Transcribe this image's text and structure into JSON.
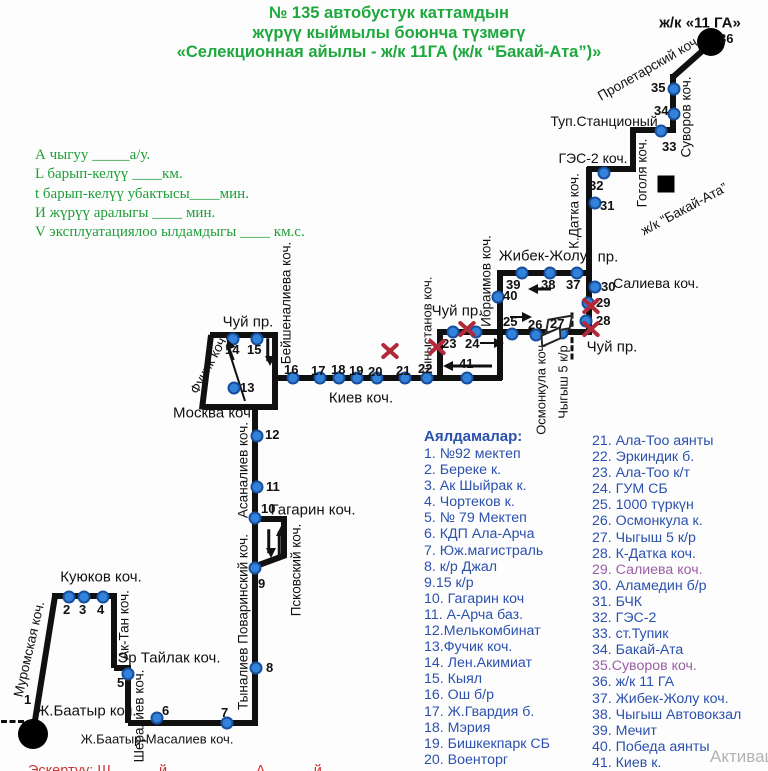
{
  "title": {
    "line1": "№ 135  автобустук каттамдын",
    "line2": "жүрүү кыймылы боюнча түзмөгү",
    "line3": "«Селекционная айылы - ж/к 11ГА (ж/к “Бакай-Ата”)»"
  },
  "legend": {
    "lines": [
      "А чыгуу  _____а/у.",
      "L барып-келүү  ____км.",
      "t барып-келүү убактысы____мин.",
      "И жүрүү аралыгы ____  мин.",
      "V эксплуатациялоо ылдамдыгы ____ км.с."
    ]
  },
  "stops_list": {
    "heading": "Аялдамалар:",
    "column1": [
      "1. №92 мектеп",
      "2. Береке к.",
      "3. Ак Шыйрак к.",
      "4. Чортеков к.",
      "5.  № 79 Мектеп",
      "6. КДП Ала-Арча",
      "7. Юж.магистраль",
      "8. к/р Джал",
      "9.15 к/р",
      "10. Гагарин коч",
      "11. А-Арча баз.",
      "12.Мелькомбинат",
      "13.Фучик коч.",
      "14. Лен.Акимиат",
      "15. Кыял",
      "16. Ош б/р",
      "17. Ж.Гвардия б.",
      "18. Мэрия",
      "19. Бишкекпарк СБ",
      "20. Военторг"
    ],
    "column2": [
      "21. Ала-Тоо аянты",
      "22. Эркиндик б.",
      "23. Ала-Тоо к/т",
      "24. ГУМ СБ",
      "25. 1000 түркүн",
      "26. Осмонкула к.",
      "27. Чыгыш 5 к/р",
      "28. К-Датка коч.",
      "29. Салиева коч.",
      "30. Аламедин б/р",
      "31. БЧК",
      "32. ГЭС-2",
      "33. ст.Тупик",
      "34. Бакай-Ата",
      "35.Суворов коч.",
      "36. ж/к 11 ГА",
      "37. Жибек-Жолу коч.",
      "38. Чыгыш Автовокзал",
      "39. Мечит",
      "40. Победа аянты",
      "41. Киев к."
    ],
    "purple_items": [
      "29. Салиева коч.",
      "35.Суворов коч."
    ]
  },
  "map": {
    "segments": [
      [
        33,
        733,
        55,
        596
      ],
      [
        52,
        596,
        117,
        596
      ],
      [
        114,
        596,
        114,
        668
      ],
      [
        114,
        668,
        131,
        668
      ],
      [
        128,
        668,
        128,
        723
      ],
      [
        128,
        723,
        258,
        723
      ],
      [
        255,
        726,
        255,
        406
      ],
      [
        255,
        519,
        287,
        519
      ],
      [
        284,
        519,
        284,
        557
      ],
      [
        286,
        555,
        256,
        566
      ],
      [
        210,
        335,
        278,
        335
      ],
      [
        275,
        335,
        275,
        410
      ],
      [
        204,
        407,
        278,
        407
      ],
      [
        211,
        335,
        202,
        409
      ],
      [
        245,
        401,
        227,
        345,
        2
      ],
      [
        275,
        378,
        502,
        378
      ],
      [
        440,
        331,
        440,
        380
      ],
      [
        437,
        332,
        592,
        332
      ],
      [
        500,
        271,
        500,
        380
      ],
      [
        497,
        273,
        592,
        273
      ],
      [
        589,
        167,
        589,
        335
      ],
      [
        587,
        169,
        636,
        169
      ],
      [
        633,
        169,
        633,
        131
      ],
      [
        630,
        130,
        676,
        130
      ],
      [
        673,
        132,
        673,
        74
      ],
      [
        673,
        77,
        709,
        45
      ]
    ],
    "dashed": [
      [
        1,
        720,
        24,
        720
      ],
      [
        572,
        311,
        572,
        358
      ]
    ],
    "terminals": [
      {
        "shape": "circle",
        "x": 33,
        "y": 734,
        "r": 15,
        "label": "terminus-zh-baatyr"
      },
      {
        "shape": "circle",
        "x": 711,
        "y": 42,
        "r": 14,
        "label": "terminus-11ga"
      },
      {
        "shape": "square",
        "x": 666,
        "y": 184,
        "s": 17,
        "label": "bakai-ata-marker"
      }
    ],
    "stops": [
      {
        "n": "1",
        "dot": false,
        "lx": 24,
        "ly": 692
      },
      {
        "n": "2",
        "x": 69,
        "y": 597,
        "lx": 63,
        "ly": 602
      },
      {
        "n": "3",
        "x": 84,
        "y": 597,
        "lx": 79,
        "ly": 602
      },
      {
        "n": "4",
        "x": 103,
        "y": 597,
        "lx": 97,
        "ly": 602
      },
      {
        "n": "5",
        "x": 128,
        "y": 674,
        "lx": 117,
        "ly": 675
      },
      {
        "n": "6",
        "x": 157,
        "y": 718,
        "lx": 162,
        "ly": 703
      },
      {
        "n": "7",
        "x": 227,
        "y": 723,
        "lx": 221,
        "ly": 705
      },
      {
        "n": "8",
        "x": 256,
        "y": 668,
        "lx": 266,
        "ly": 660
      },
      {
        "n": "9",
        "x": 255,
        "y": 568,
        "lx": 258,
        "ly": 576
      },
      {
        "n": "10",
        "x": 255,
        "y": 518,
        "lx": 261,
        "ly": 501
      },
      {
        "n": "11",
        "x": 257,
        "y": 487,
        "lx": 266,
        "ly": 479
      },
      {
        "n": "12",
        "x": 257,
        "y": 436,
        "lx": 265,
        "ly": 427
      },
      {
        "n": "13",
        "x": 234,
        "y": 388,
        "lx": 240,
        "ly": 380
      },
      {
        "n": "14",
        "x": 233,
        "y": 339,
        "lx": 225,
        "ly": 342
      },
      {
        "n": "15",
        "x": 257,
        "y": 339,
        "lx": 247,
        "ly": 342
      },
      {
        "n": "16",
        "x": 293,
        "y": 378,
        "lx": 284,
        "ly": 362
      },
      {
        "n": "17",
        "x": 320,
        "y": 378,
        "lx": 311,
        "ly": 363
      },
      {
        "n": "18",
        "x": 339,
        "y": 378,
        "lx": 331,
        "ly": 362
      },
      {
        "n": "19",
        "x": 357,
        "y": 378,
        "lx": 349,
        "ly": 363
      },
      {
        "n": "20",
        "x": 377,
        "y": 378,
        "lx": 368,
        "ly": 364
      },
      {
        "n": "21",
        "x": 405,
        "y": 378,
        "lx": 396,
        "ly": 363
      },
      {
        "n": "22",
        "x": 427,
        "y": 378,
        "lx": 418,
        "ly": 361
      },
      {
        "n": "23",
        "x": 453,
        "y": 332,
        "lx": 442,
        "ly": 336
      },
      {
        "n": "24",
        "x": 476,
        "y": 332,
        "lx": 465,
        "ly": 336
      },
      {
        "n": "25",
        "x": 512,
        "y": 334,
        "lx": 503,
        "ly": 314
      },
      {
        "n": "26",
        "x": 536,
        "y": 335,
        "lx": 528,
        "ly": 317
      },
      {
        "n": "27",
        "x": 562,
        "y": 333,
        "lx": 550,
        "ly": 316
      },
      {
        "n": "28",
        "x": 586,
        "y": 321,
        "lx": 596,
        "ly": 313
      },
      {
        "n": "29",
        "x": 588,
        "y": 303,
        "lx": 596,
        "ly": 295
      },
      {
        "n": "30",
        "x": 595,
        "y": 287,
        "lx": 601,
        "ly": 279
      },
      {
        "n": "31",
        "x": 595,
        "y": 203,
        "lx": 600,
        "ly": 198
      },
      {
        "n": "32",
        "x": 604,
        "y": 173,
        "lx": 589,
        "ly": 178
      },
      {
        "n": "33",
        "x": 661,
        "y": 131,
        "lx": 662,
        "ly": 139
      },
      {
        "n": "34",
        "x": 674,
        "y": 114,
        "lx": 654,
        "ly": 103
      },
      {
        "n": "35",
        "x": 674,
        "y": 89,
        "lx": 651,
        "ly": 80
      },
      {
        "n": "36",
        "dot": false,
        "lx": 719,
        "ly": 31
      },
      {
        "n": "37",
        "x": 577,
        "y": 273,
        "lx": 566,
        "ly": 277
      },
      {
        "n": "38",
        "x": 550,
        "y": 273,
        "lx": 541,
        "ly": 277
      },
      {
        "n": "39",
        "x": 522,
        "y": 273,
        "lx": 506,
        "ly": 277
      },
      {
        "n": "40",
        "x": 498,
        "y": 297,
        "lx": 503,
        "ly": 288
      },
      {
        "n": "41",
        "x": 467,
        "y": 378,
        "lx": 459,
        "ly": 356
      }
    ],
    "streets": [
      {
        "t": "ж/к «11 ГА»",
        "x": 700,
        "y": 23,
        "fs": 15,
        "b": true
      },
      {
        "t": "Пролетарский коч.",
        "x": 649,
        "y": 68,
        "r": -30
      },
      {
        "t": "Туп.Станционый",
        "x": 604,
        "y": 121,
        "fs": 14
      },
      {
        "t": "Суворов коч.",
        "x": 686,
        "y": 117,
        "r": -90
      },
      {
        "t": "ГЭС-2 коч.",
        "x": 593,
        "y": 158,
        "fs": 14
      },
      {
        "t": "Гоголя коч.",
        "x": 642,
        "y": 173,
        "r": -90
      },
      {
        "t": "ж/к “Бакай-Ата”",
        "x": 684,
        "y": 209,
        "r": -28
      },
      {
        "t": "К.Датка коч.",
        "x": 574,
        "y": 211,
        "r": -90
      },
      {
        "t": "Жибек-Жолу",
        "x": 543,
        "y": 256,
        "fs": 15
      },
      {
        "t": "пр.",
        "x": 608,
        "y": 257,
        "fs": 15
      },
      {
        "t": "Салиева коч.",
        "x": 656,
        "y": 283,
        "fs": 14
      },
      {
        "t": "Ибраимов  коч.",
        "x": 486,
        "y": 281,
        "r": -90
      },
      {
        "t": "Чуй пр.",
        "x": 612,
        "y": 347,
        "fs": 15
      },
      {
        "t": "Чуй пр.",
        "x": 457,
        "y": 311,
        "fs": 15
      },
      {
        "t": "Чуй пр.",
        "x": 248,
        "y": 322,
        "fs": 15
      },
      {
        "t": "Тыныстанов коч.",
        "x": 427,
        "y": 327,
        "r": -90,
        "fs": 13
      },
      {
        "t": "Осмонкула коч.",
        "x": 541,
        "y": 388,
        "r": -90,
        "fs": 13
      },
      {
        "t": "Чыгыш 5 к/р",
        "x": 563,
        "y": 382,
        "r": -90,
        "fs": 13
      },
      {
        "t": "Бейшеналиева коч.",
        "x": 286,
        "y": 303,
        "r": -90
      },
      {
        "t": "Фучик коч.",
        "x": 209,
        "y": 364,
        "r": -62
      },
      {
        "t": "Киев коч.",
        "x": 361,
        "y": 398,
        "fs": 15
      },
      {
        "t": "Москва коч.",
        "x": 214,
        "y": 413,
        "fs": 15
      },
      {
        "t": "Асаналиев коч.",
        "x": 243,
        "y": 470,
        "r": -90
      },
      {
        "t": "Гагарин  коч.",
        "x": 313,
        "y": 510,
        "fs": 15
      },
      {
        "t": "Псковский коч.",
        "x": 296,
        "y": 570,
        "r": -90
      },
      {
        "t": "Тыналиев Поваринский коч.",
        "x": 243,
        "y": 622,
        "r": -90
      },
      {
        "t": "Куюков коч.",
        "x": 101,
        "y": 577,
        "fs": 15
      },
      {
        "t": "Муромская коч.",
        "x": 29,
        "y": 649,
        "r": -77
      },
      {
        "t": "Ак-Тан коч.",
        "x": 124,
        "y": 625,
        "r": -90
      },
      {
        "t": "Эр Тайлак коч.",
        "x": 169,
        "y": 658,
        "fs": 15
      },
      {
        "t": "Шералиев коч.",
        "x": 139,
        "y": 716,
        "r": -90
      },
      {
        "t": "Ж.Баатыр  коч.",
        "x": 86,
        "y": 711,
        "fs": 15
      },
      {
        "t": "Ж.Баатыр-Масалиев  коч.",
        "x": 157,
        "y": 739,
        "fs": 13
      }
    ],
    "arrows": [
      [
        480,
        343,
        497,
        343
      ],
      [
        492,
        366,
        446,
        366
      ],
      [
        510,
        317,
        525,
        317
      ],
      [
        551,
        289,
        531,
        289
      ],
      [
        268,
        338,
        268,
        361
      ],
      [
        233,
        360,
        227,
        344
      ],
      [
        269,
        529,
        269,
        553
      ],
      [
        279,
        556,
        279,
        531
      ]
    ],
    "xmarks": [
      [
        390,
        351
      ],
      [
        437,
        347
      ],
      [
        467,
        329
      ],
      [
        591,
        306
      ],
      [
        591,
        329
      ]
    ],
    "white_shapes": [
      [
        546,
        317,
        26,
        14,
        -10
      ],
      [
        540,
        331,
        22,
        12,
        -24
      ]
    ]
  },
  "footnote": "Эскертуу: Ш............й .................... А............й",
  "watermark": "Активаци",
  "colors": {
    "title_green": "#1ea83e",
    "legend_green": "#1e9e38",
    "list_blue": "#2b51ad",
    "list_purple": "#9a5fa5",
    "route_black": "#101010",
    "stop_dot_fill": "#3182d8",
    "stop_dot_border": "#174f9e",
    "closed_x_red": "#b22a3a",
    "footnote_red": "#cc3333",
    "watermark_gray": "#b3b3b6"
  }
}
